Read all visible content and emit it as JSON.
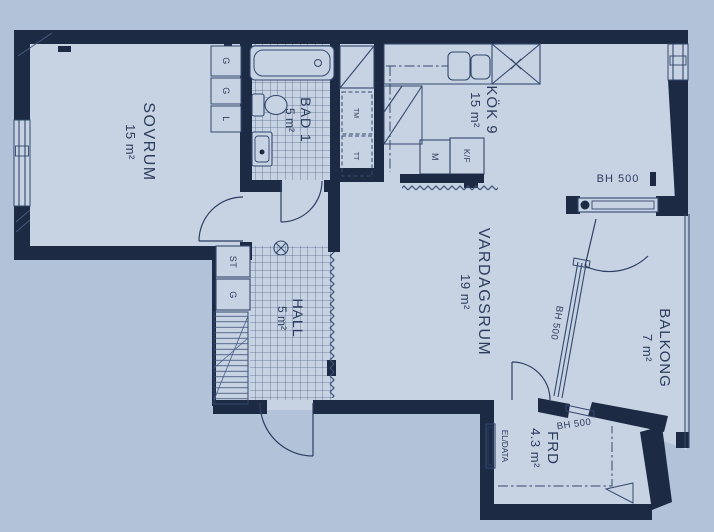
{
  "title": "apartment-floor-plan",
  "colors": {
    "background": "#b2c2d8",
    "room_fill": "#c7d2e2",
    "wall": "#1c2a44",
    "line": "#33496e",
    "text": "#2b3d5e"
  },
  "rooms": {
    "sovrum": {
      "label": "SOVRUM",
      "area": "15 m²"
    },
    "bad": {
      "label": "BAD 1",
      "area": "5 m²"
    },
    "kok": {
      "label": "KÖK 9",
      "area": "15 m²"
    },
    "vardagsrum": {
      "label": "VARDAGSRUM",
      "area": "19 m²"
    },
    "hall": {
      "label": "HALL",
      "area": "5 m²"
    },
    "balkong": {
      "label": "BALKONG",
      "area": "7 m²"
    },
    "frd": {
      "label": "FRD",
      "area": "4.3 m²"
    }
  },
  "fixtures": {
    "cabinets_top": [
      "G",
      "G",
      "L"
    ],
    "hall_cabinets": [
      "ST",
      "G"
    ],
    "laundry": [
      "TM",
      "TT"
    ],
    "kitchen_units": [
      "M",
      "K/F"
    ],
    "el_data": "EL/DATA"
  },
  "annotations": {
    "bh500_top": "BH 500",
    "bh500_window": "BH 500",
    "bh500_frd": "BH 500"
  }
}
